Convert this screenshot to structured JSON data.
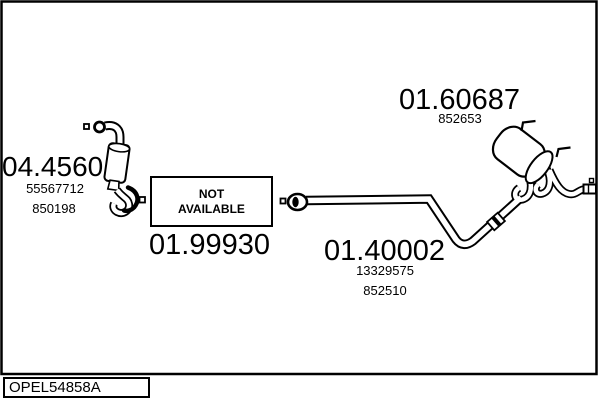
{
  "title": "Exhaust system parts diagram",
  "colors": {
    "line": "#000000",
    "background": "#ffffff",
    "text": "#000000"
  },
  "parts": {
    "catalyst": {
      "code": "04.4560",
      "ref1": "55567712",
      "ref2": "850198"
    },
    "front_pipe": {
      "code": "01.99930",
      "availability_line1": "NOT",
      "availability_line2": "AVAILABLE"
    },
    "centre_pipe": {
      "code": "01.40002",
      "ref1": "13329575",
      "ref2": "852510"
    },
    "rear_silencer": {
      "code": "01.60687",
      "ref1": "852653"
    }
  },
  "footer": {
    "vehicle_code": "OPEL54858A"
  },
  "icons": {
    "connection_marker": "small-square",
    "flange": "ring",
    "flex_joint": "thick-arc",
    "clamp": "banded-sleeve"
  }
}
